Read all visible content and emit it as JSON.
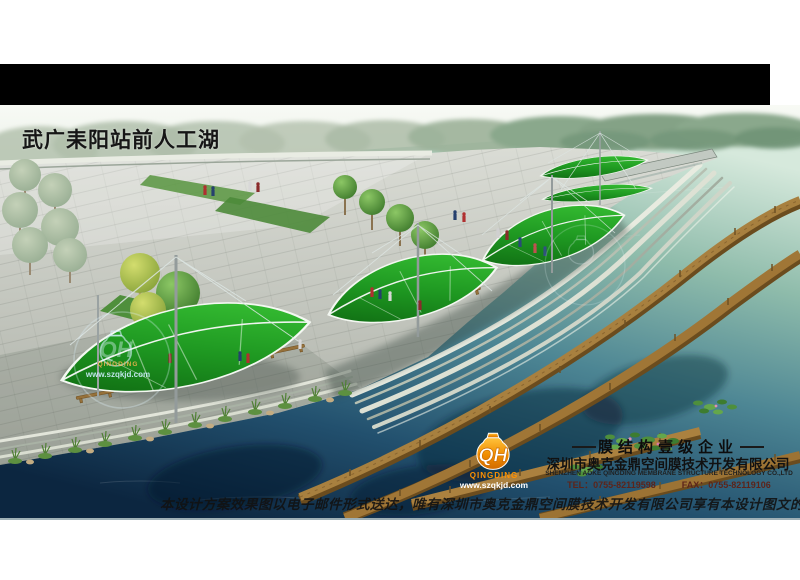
{
  "title": "武广耒阳站前人工湖",
  "brand": {
    "monogram": "QH",
    "name": "QINGDING",
    "website": "www.szqkjd.com"
  },
  "footer": {
    "grade": "膜结构壹级企业",
    "company_cn": "深圳市奥克金鼎空间膜技术开发有限公司",
    "company_en": "SHENZHEN AOKE QINGDING MEMBRANE STRUCTURE TECHNOLOGY CO.,LTD",
    "tel_label": "TEL：",
    "tel": "0755-82119598",
    "fax_label": "FAX：",
    "fax": "0755-82119106"
  },
  "copyright": "本设计方案效果图以电子邮件形式送达，唯有深圳市奥克金鼎空间膜技术开发有限公司享有本设计图文的知识产权及著作权",
  "colors": {
    "canopy_green": "#2fb32f",
    "boardwalk_brown": "#a8803f",
    "water_deep": "#16324c",
    "water_light": "#cfe5da",
    "plaza_gray": "#c9cbc7",
    "logo_orange": "#f59300"
  }
}
